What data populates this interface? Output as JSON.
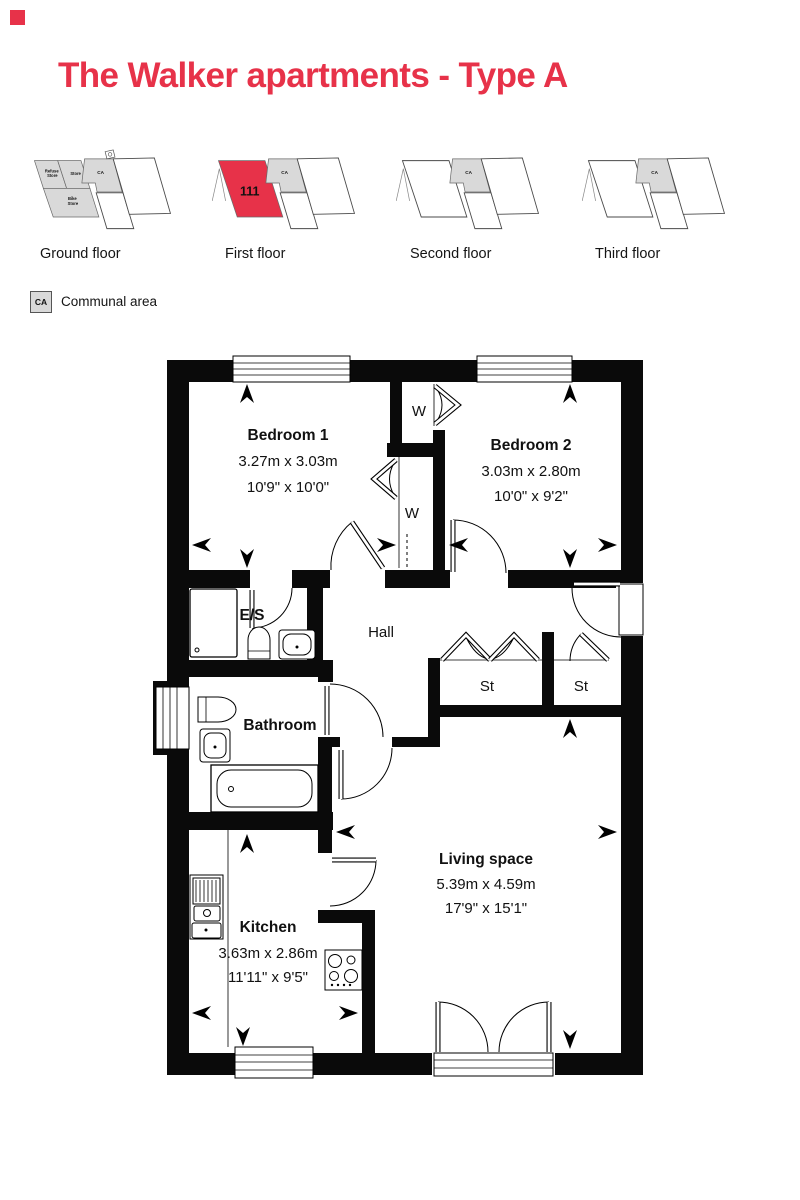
{
  "brand": {
    "accent_color": "#e73249"
  },
  "page_title": "The Walker apartments - Type A",
  "floors": {
    "ground": {
      "label": "Ground floor",
      "refuse_store": [
        "Refuse",
        "Store"
      ],
      "store": "Store",
      "bike_store": [
        "Bike",
        "Store"
      ],
      "ca": "CA"
    },
    "first": {
      "label": "First floor",
      "unit_number": "111",
      "ca": "CA"
    },
    "second": {
      "label": "Second floor",
      "ca": "CA"
    },
    "third": {
      "label": "Third floor",
      "ca": "CA"
    }
  },
  "legend": {
    "key": "CA",
    "label": "Communal area"
  },
  "plan": {
    "bedroom1": {
      "name": "Bedroom 1",
      "metric": "3.27m x 3.03m",
      "imperial": "10'9\" x 10'0\""
    },
    "bedroom2": {
      "name": "Bedroom 2",
      "metric": "3.03m x 2.80m",
      "imperial": "10'0\" x 9'2\""
    },
    "kitchen": {
      "name": "Kitchen",
      "metric": "3.63m x 2.86m",
      "imperial": "11'11\" x 9'5\""
    },
    "living": {
      "name": "Living space",
      "metric": "5.39m x 4.59m",
      "imperial": "17'9\" x 15'1\""
    },
    "hall": {
      "name": "Hall"
    },
    "bathroom": {
      "name": "Bathroom"
    },
    "ensuite": {
      "name": "E/S"
    },
    "store_left": {
      "name": "St"
    },
    "store_right": {
      "name": "St"
    },
    "wardrobe_top": {
      "name": "W"
    },
    "wardrobe_bottom": {
      "name": "W"
    }
  }
}
